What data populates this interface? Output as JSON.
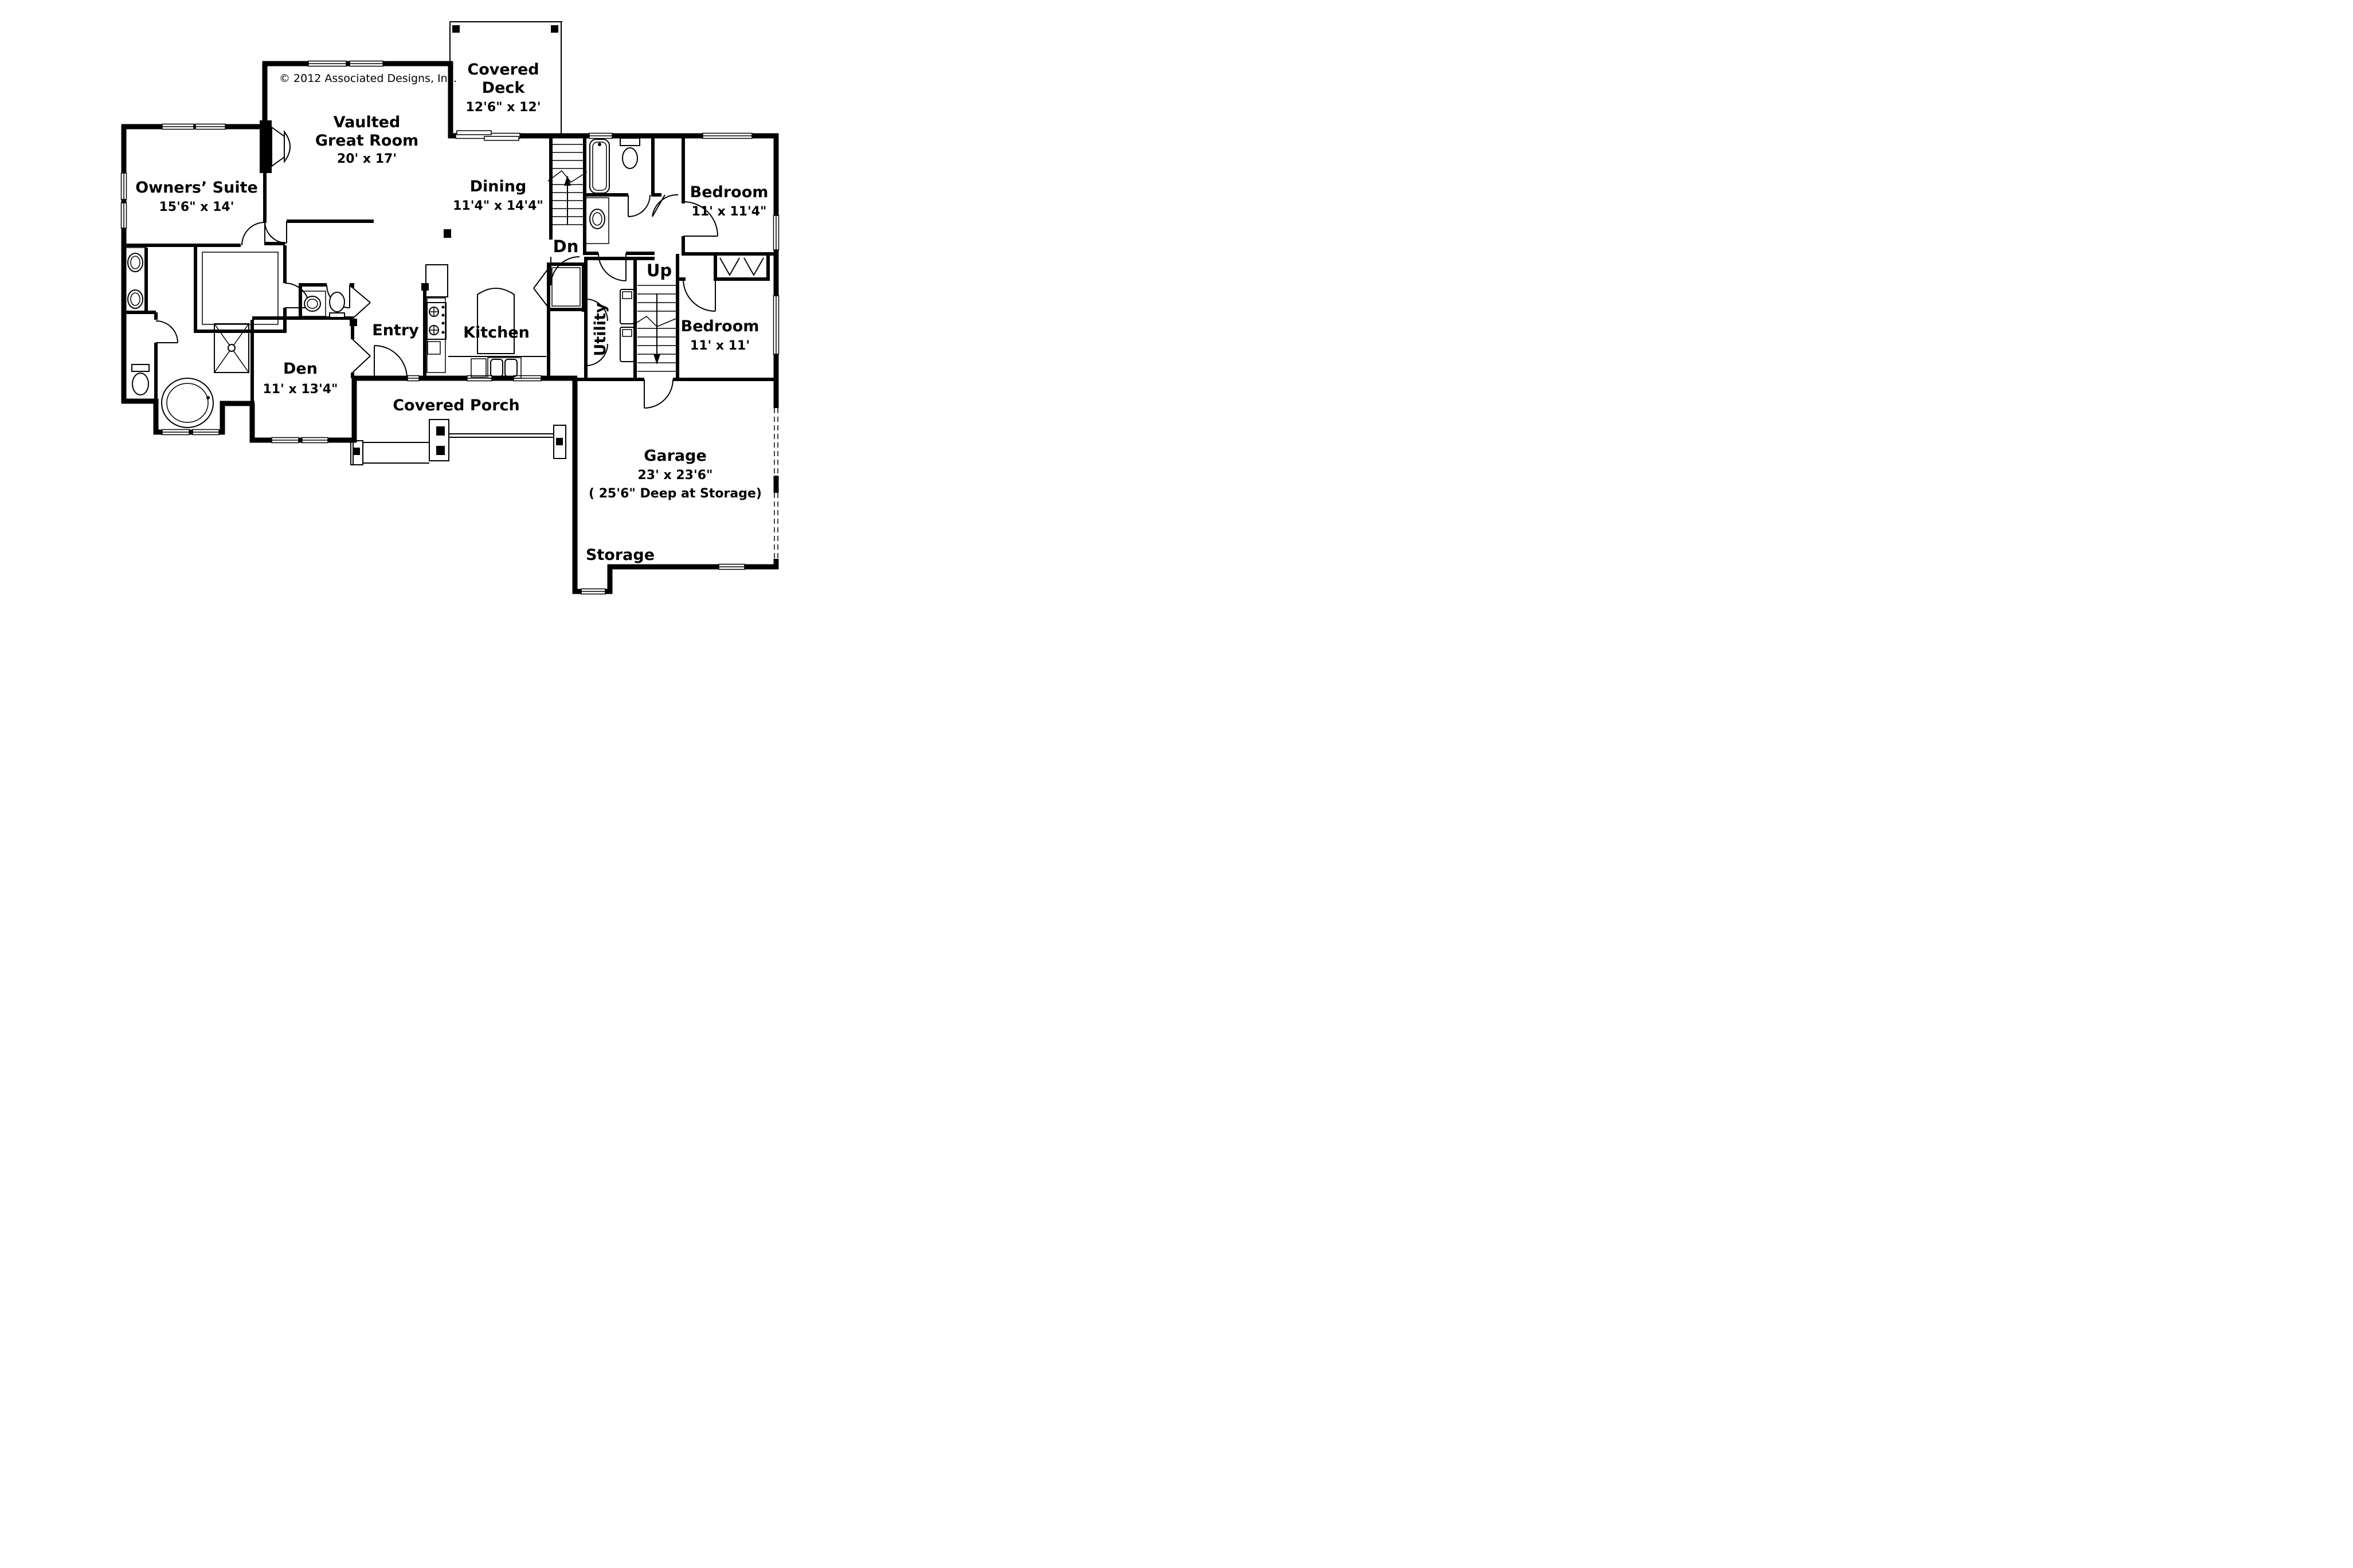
{
  "copyright": "© 2012 Associated Designs, Inc.",
  "colors": {
    "ink": "#000000",
    "paper": "#ffffff"
  },
  "rooms": {
    "covered_deck": {
      "line1": "Covered",
      "line2": "Deck",
      "dims": "12'6\" x 12'"
    },
    "great_room": {
      "line1": "Vaulted",
      "line2": "Great Room",
      "dims": "20' x 17'"
    },
    "owners_suite": {
      "name": "Owners’ Suite",
      "dims": "15'6\" x 14'"
    },
    "dining": {
      "name": "Dining",
      "dims": "11'4\" x 14'4\""
    },
    "bedroom1": {
      "name": "Bedroom",
      "dims": "11' x 11'4\""
    },
    "bedroom2": {
      "name": "Bedroom",
      "dims": "11' x 11'"
    },
    "den": {
      "name": "Den",
      "dims": "11' x 13'4\""
    },
    "kitchen": {
      "name": "Kitchen"
    },
    "entry": {
      "name": "Entry"
    },
    "utility": {
      "name": "Utility"
    },
    "covered_porch": {
      "name": "Covered Porch"
    },
    "garage": {
      "name": "Garage",
      "dims": "23' x 23'6\"",
      "note": "( 25'6\" Deep at Storage)"
    },
    "storage": {
      "name": "Storage"
    }
  },
  "stairs": {
    "down": "Dn",
    "up": "Up"
  }
}
